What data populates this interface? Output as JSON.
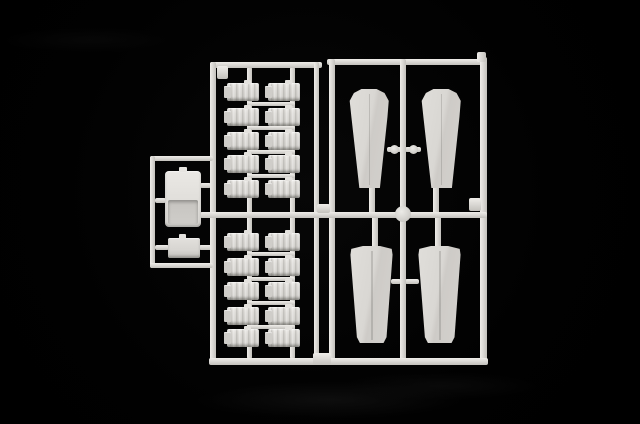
{
  "scene": {
    "description": "Photograph of a white injection-molded plastic model kit sprue (parts runner) lying on a black background",
    "background_color": "#000000",
    "plastic_color": "#dcdad6",
    "highlight_color": "#efede9",
    "shadow_color": "#b9b7b2",
    "part_counts": {
      "propeller_blades": 4,
      "engine_cylinders": 20,
      "cowling_parts": 1,
      "rectangular_panels": 1
    }
  },
  "sprue": {
    "runners": [
      {
        "x": 210,
        "y": 62,
        "w": 112,
        "h": 6,
        "d": "h",
        "n": "top-rail-left-frame",
        "z": 2
      },
      {
        "x": 210,
        "y": 62,
        "w": 6,
        "h": 303,
        "d": "v",
        "n": "left-rail-left-frame",
        "z": 2
      },
      {
        "x": 314,
        "y": 62,
        "w": 5,
        "h": 298,
        "d": "v",
        "n": "right-rail-left-frame",
        "z": 2
      },
      {
        "x": 327,
        "y": 59,
        "w": 159,
        "h": 6,
        "d": "h",
        "n": "top-rail-right-frame",
        "z": 2
      },
      {
        "x": 329,
        "y": 59,
        "w": 6,
        "h": 301,
        "d": "v",
        "n": "left-rail-right-frame",
        "z": 2
      },
      {
        "x": 400,
        "y": 59,
        "w": 6,
        "h": 303,
        "d": "v",
        "n": "middle-rail-right-frame",
        "z": 2
      },
      {
        "x": 480,
        "y": 57,
        "w": 7,
        "h": 305,
        "d": "v",
        "n": "right-rail-right-frame",
        "z": 2
      },
      {
        "x": 209,
        "y": 358,
        "w": 279,
        "h": 7,
        "d": "h",
        "n": "bottom-rail",
        "z": 2
      },
      {
        "x": 200,
        "y": 212,
        "w": 287,
        "h": 6,
        "d": "h",
        "n": "mid-rail",
        "z": 2
      },
      {
        "x": 150,
        "y": 156,
        "w": 63,
        "h": 5,
        "d": "h",
        "n": "loop-top-rail",
        "z": 2
      },
      {
        "x": 150,
        "y": 156,
        "w": 5,
        "h": 112,
        "d": "v",
        "n": "loop-left-rail",
        "z": 2
      },
      {
        "x": 150,
        "y": 263,
        "w": 63,
        "h": 5,
        "d": "h",
        "n": "loop-bottom-rail",
        "z": 2
      },
      {
        "x": 247,
        "y": 67,
        "w": 5,
        "h": 292,
        "d": "v",
        "n": "cylinder-stem-left",
        "z": 1
      },
      {
        "x": 290,
        "y": 67,
        "w": 5,
        "h": 292,
        "d": "v",
        "n": "cylinder-stem-right",
        "z": 1
      },
      {
        "x": 247,
        "y": 101.5,
        "w": 48,
        "h": 4,
        "d": "h",
        "n": "cylinder-tie",
        "z": 1
      },
      {
        "x": 247,
        "y": 126,
        "w": 48,
        "h": 4,
        "d": "h",
        "n": "cylinder-tie",
        "z": 1
      },
      {
        "x": 247,
        "y": 149.5,
        "w": 48,
        "h": 4,
        "d": "h",
        "n": "cylinder-tie",
        "z": 1
      },
      {
        "x": 247,
        "y": 173.5,
        "w": 48,
        "h": 4,
        "d": "h",
        "n": "cylinder-tie",
        "z": 1
      },
      {
        "x": 247,
        "y": 252,
        "w": 48,
        "h": 4,
        "d": "h",
        "n": "cylinder-tie",
        "z": 1
      },
      {
        "x": 247,
        "y": 276.5,
        "w": 48,
        "h": 4,
        "d": "h",
        "n": "cylinder-tie",
        "z": 1
      },
      {
        "x": 247,
        "y": 300.5,
        "w": 48,
        "h": 4,
        "d": "h",
        "n": "cylinder-tie",
        "z": 1
      },
      {
        "x": 247,
        "y": 324.5,
        "w": 48,
        "h": 4,
        "d": "h",
        "n": "cylinder-tie",
        "z": 1
      },
      {
        "x": 369,
        "y": 184,
        "w": 6,
        "h": 30,
        "d": "v",
        "n": "blade-stem",
        "z": 1
      },
      {
        "x": 433,
        "y": 184,
        "w": 6,
        "h": 30,
        "d": "v",
        "n": "blade-stem",
        "z": 1
      },
      {
        "x": 372,
        "y": 216,
        "w": 6,
        "h": 32,
        "d": "v",
        "n": "blade-stem",
        "z": 1
      },
      {
        "x": 435,
        "y": 216,
        "w": 6,
        "h": 32,
        "d": "v",
        "n": "blade-stem",
        "z": 1
      },
      {
        "x": 387,
        "y": 147,
        "w": 14,
        "h": 5,
        "d": "h",
        "n": "blade-tie",
        "z": 1
      },
      {
        "x": 405,
        "y": 147,
        "w": 16,
        "h": 5,
        "d": "h",
        "n": "blade-tie",
        "z": 1
      },
      {
        "x": 391,
        "y": 279,
        "w": 10,
        "h": 5,
        "d": "h",
        "n": "blade-tie",
        "z": 1
      },
      {
        "x": 405,
        "y": 279,
        "w": 14,
        "h": 5,
        "d": "h",
        "n": "blade-tie",
        "z": 1
      },
      {
        "x": 155,
        "y": 198,
        "w": 11,
        "h": 5,
        "d": "h",
        "n": "cowl-stub",
        "z": 1
      },
      {
        "x": 200,
        "y": 183,
        "w": 11,
        "h": 5,
        "d": "h",
        "n": "cowl-stub",
        "z": 1
      },
      {
        "x": 155,
        "y": 245,
        "w": 14,
        "h": 5,
        "d": "h",
        "n": "panel-stub",
        "z": 1
      },
      {
        "x": 199,
        "y": 245,
        "w": 13,
        "h": 5,
        "d": "h",
        "n": "panel-stub",
        "z": 1
      },
      {
        "x": 217,
        "y": 66,
        "w": 11,
        "h": 13,
        "d": "h",
        "n": "corner-gusset",
        "z": 3
      },
      {
        "x": 477,
        "y": 52,
        "w": 9,
        "h": 10,
        "d": "v",
        "n": "corner-stub",
        "z": 3
      },
      {
        "x": 469,
        "y": 198,
        "w": 12,
        "h": 13,
        "d": "h",
        "n": "rail-tab",
        "z": 3
      },
      {
        "x": 317,
        "y": 204,
        "w": 13,
        "h": 9,
        "d": "h",
        "n": "gap-tab",
        "z": 3
      },
      {
        "x": 313,
        "y": 353,
        "w": 18,
        "h": 12,
        "d": "h",
        "n": "gap-tab",
        "z": 3
      }
    ],
    "beads": [
      {
        "x": 395,
        "y": 206,
        "r": 8,
        "n": "junction-bead"
      },
      {
        "x": 390,
        "y": 145,
        "r": 4.5,
        "n": "tie-bead"
      },
      {
        "x": 409,
        "y": 145,
        "r": 4.5,
        "n": "tie-bead"
      }
    ],
    "cylinders": {
      "cols": [
        227,
        268
      ],
      "w": 32,
      "h": 18,
      "rows": [
        83,
        107.5,
        131.5,
        155,
        179.5,
        233,
        257.5,
        281.5,
        306.5,
        328.5
      ]
    },
    "blades": [
      {
        "x": 348,
        "y": 89,
        "w": 42,
        "h": 99,
        "t": "top"
      },
      {
        "x": 420,
        "y": 89,
        "w": 42,
        "h": 99,
        "t": "top"
      },
      {
        "x": 350,
        "y": 246,
        "w": 43,
        "h": 97,
        "t": "bottom"
      },
      {
        "x": 418,
        "y": 246,
        "w": 43,
        "h": 97,
        "t": "bottom"
      }
    ],
    "cowl": {
      "x": 165,
      "y": 171,
      "w": 36,
      "h": 56
    },
    "panel": {
      "x": 168,
      "y": 238,
      "w": 32,
      "h": 20
    }
  }
}
